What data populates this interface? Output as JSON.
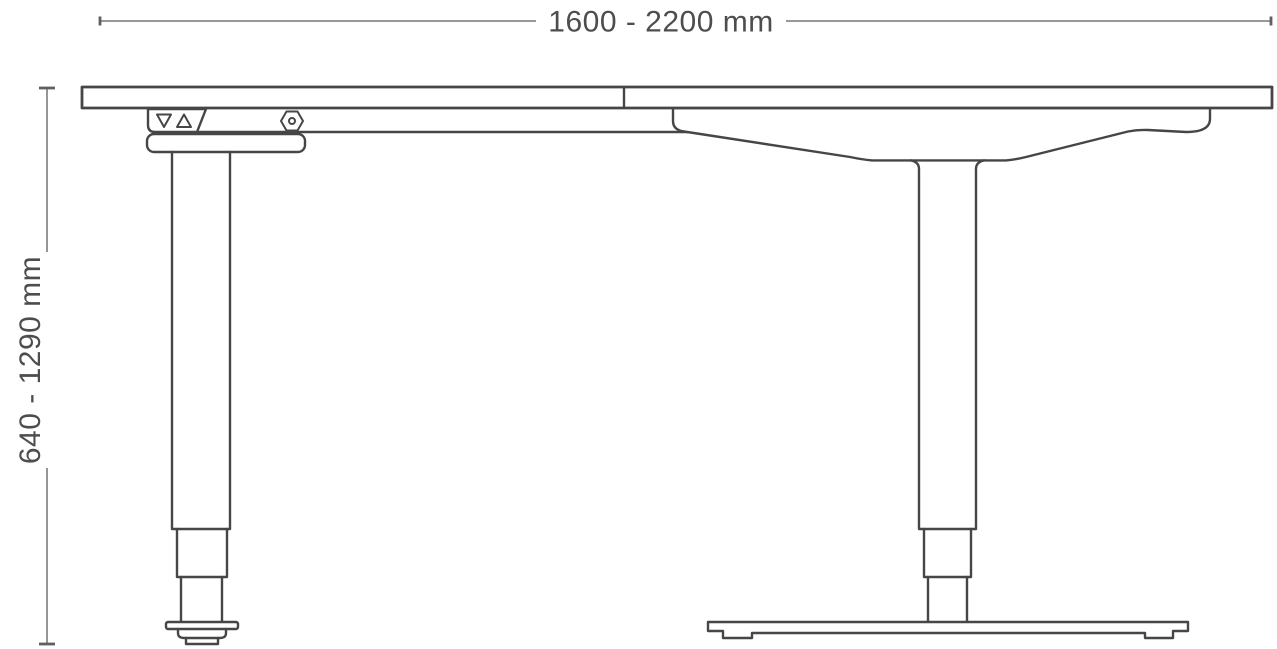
{
  "diagram": {
    "subject": "height-adjustable desk side elevation drawing",
    "width_dimension": {
      "label": "1600 - 2200 mm"
    },
    "height_dimension": {
      "label": "640 - 1290 mm"
    },
    "icons": {
      "down_button": "triangle-down-icon",
      "up_button": "triangle-up-icon",
      "bolt": "hex-bolt-icon"
    },
    "colors": {
      "outline": "#464646",
      "dimension_line": "#8a8a8a",
      "dimension_tick": "#606060",
      "label_text": "#4d4d4d",
      "background": "#ffffff"
    }
  }
}
